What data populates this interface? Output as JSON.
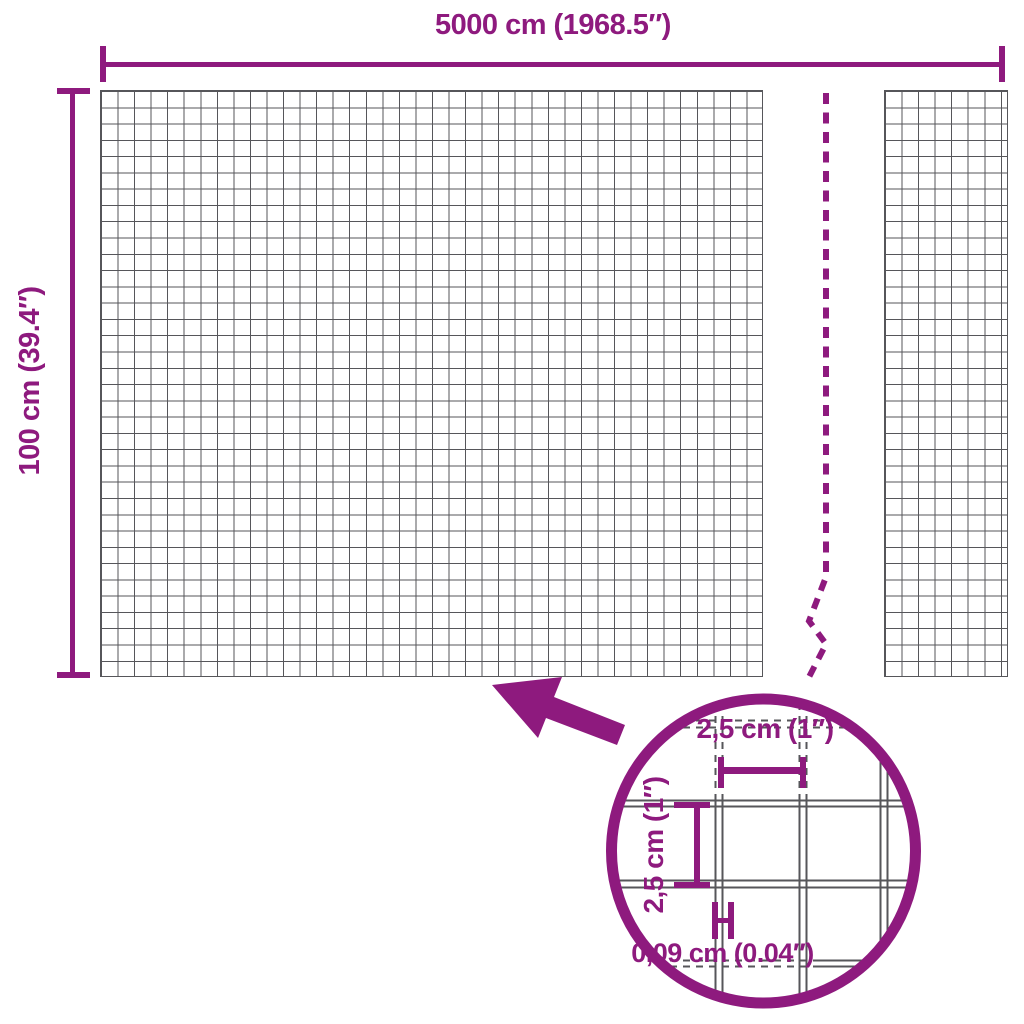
{
  "colors": {
    "accent": "#8e1a7e",
    "mesh_line": "#56565a",
    "background": "#ffffff"
  },
  "dimensions": {
    "width_label": "5000 cm (1968.5″)",
    "height_label": "100 cm (39.4″)"
  },
  "detail_view": {
    "cell_width_label": "2,5 cm (1″)",
    "cell_height_label": "2,5 cm (1″)",
    "wire_thickness_label": "0,09 cm (0.04″)"
  }
}
